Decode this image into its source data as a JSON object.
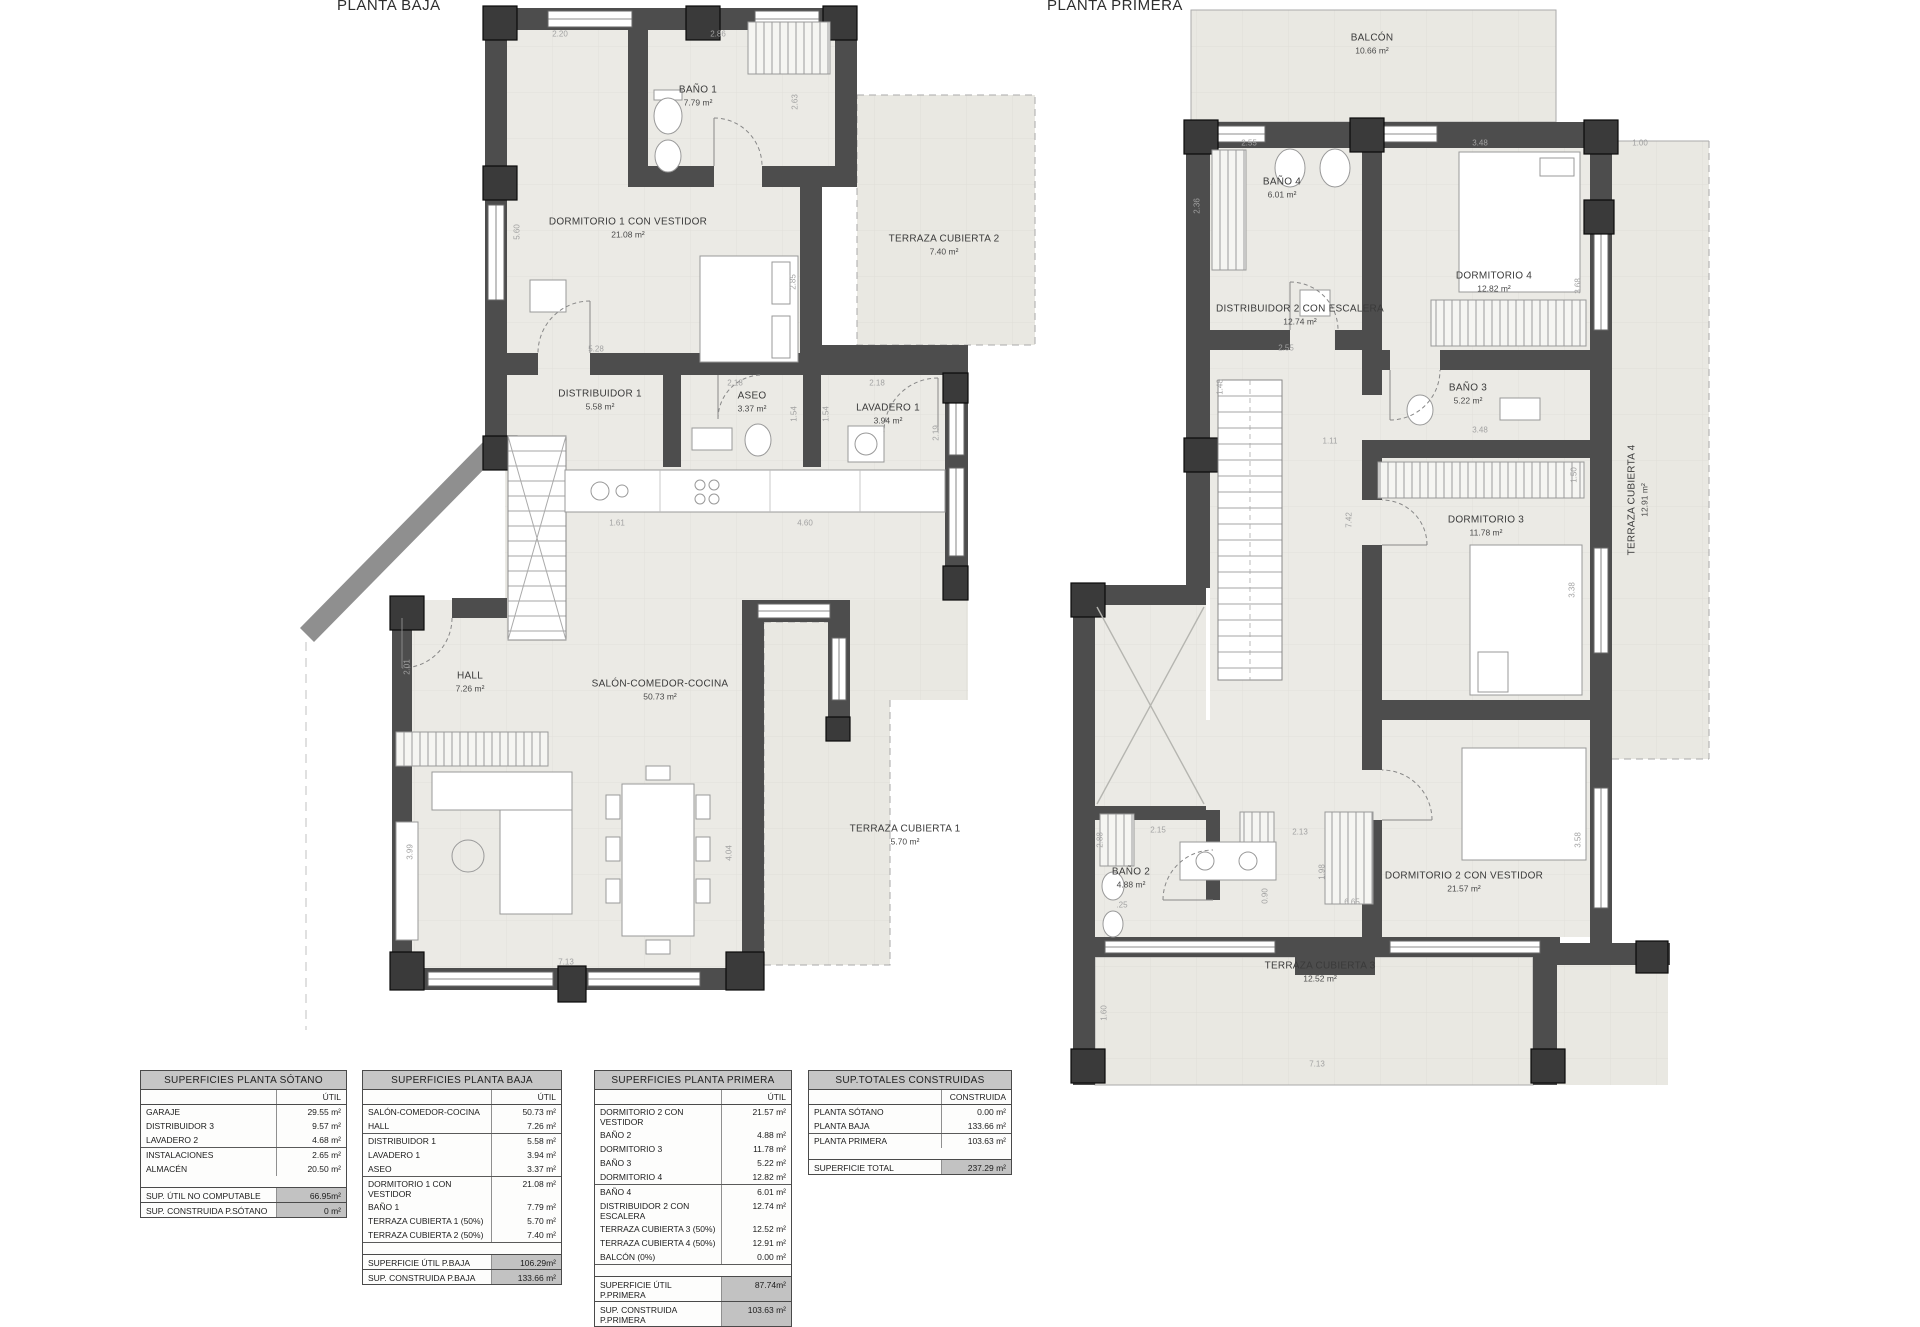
{
  "plans": [
    {
      "id": "baja",
      "title": "PLANTA BAJA",
      "rooms": [
        {
          "name": "BAÑO 1",
          "area": "7.79 m²",
          "x": 698,
          "y": 96
        },
        {
          "name": "DORMITORIO 1 CON VESTIDOR",
          "area": "21.08 m²",
          "x": 628,
          "y": 228
        },
        {
          "name": "TERRAZA CUBIERTA 2",
          "area": "7.40 m²",
          "x": 944,
          "y": 245
        },
        {
          "name": "DISTRIBUIDOR 1",
          "area": "5.58 m²",
          "x": 600,
          "y": 400
        },
        {
          "name": "ASEO",
          "area": "3.37 m²",
          "x": 752,
          "y": 402
        },
        {
          "name": "LAVADERO 1",
          "area": "3.94 m²",
          "x": 888,
          "y": 414
        },
        {
          "name": "HALL",
          "area": "7.26 m²",
          "x": 470,
          "y": 682
        },
        {
          "name": "SALÓN-COMEDOR-COCINA",
          "area": "50.73 m²",
          "x": 660,
          "y": 690
        },
        {
          "name": "TERRAZA CUBIERTA 1",
          "area": "5.70 m²",
          "x": 905,
          "y": 835
        }
      ],
      "dims": [
        {
          "t": "2.20",
          "x": 560,
          "y": 34
        },
        {
          "t": "2.86",
          "x": 718,
          "y": 34
        },
        {
          "t": "5.60",
          "x": 517,
          "y": 232,
          "rot": 1
        },
        {
          "t": "2.63",
          "x": 795,
          "y": 102,
          "rot": 1
        },
        {
          "t": "2.85",
          "x": 793,
          "y": 282,
          "rot": 1
        },
        {
          "t": "5.28",
          "x": 596,
          "y": 349
        },
        {
          "t": "2.18",
          "x": 735,
          "y": 383
        },
        {
          "t": "2.18",
          "x": 877,
          "y": 383
        },
        {
          "t": "1.54",
          "x": 794,
          "y": 414,
          "rot": 1
        },
        {
          "t": "1.54",
          "x": 826,
          "y": 414,
          "rot": 1
        },
        {
          "t": "2.19",
          "x": 936,
          "y": 433,
          "rot": 1
        },
        {
          "t": "1.61",
          "x": 617,
          "y": 523
        },
        {
          "t": "4.60",
          "x": 805,
          "y": 523
        },
        {
          "t": "2.01",
          "x": 407,
          "y": 667,
          "rot": 1
        },
        {
          "t": "3.99",
          "x": 410,
          "y": 852,
          "rot": 1
        },
        {
          "t": "4.04",
          "x": 729,
          "y": 853,
          "rot": 1
        },
        {
          "t": "7.13",
          "x": 566,
          "y": 962
        }
      ]
    },
    {
      "id": "primera",
      "title": "PLANTA PRIMERA",
      "rooms": [
        {
          "name": "BALCÓN",
          "area": "10.66 m²",
          "x": 1372,
          "y": 44
        },
        {
          "name": "BAÑO 4",
          "area": "6.01 m²",
          "x": 1282,
          "y": 188
        },
        {
          "name": "DORMITORIO 4",
          "area": "12.82 m²",
          "x": 1494,
          "y": 282
        },
        {
          "name": "DISTRIBUIDOR 2 CON ESCALERA",
          "area": "12.74 m²",
          "x": 1300,
          "y": 315
        },
        {
          "name": "BAÑO 3",
          "area": "5.22 m²",
          "x": 1468,
          "y": 394
        },
        {
          "name": "DORMITORIO 3",
          "area": "11.78 m²",
          "x": 1486,
          "y": 526
        },
        {
          "name": "TERRAZA CUBIERTA 4",
          "area": "12.91 m²",
          "x": 1638,
          "y": 500,
          "rot": 1
        },
        {
          "name": "BAÑO 2",
          "area": "4.88 m²",
          "x": 1131,
          "y": 878
        },
        {
          "name": "DORMITORIO 2 CON VESTIDOR",
          "area": "21.57 m²",
          "x": 1464,
          "y": 882
        },
        {
          "name": "TERRAZA CUBIERTA 3",
          "area": "12.52 m²",
          "x": 1320,
          "y": 972
        }
      ],
      "dims": [
        {
          "t": "2.55",
          "x": 1249,
          "y": 143
        },
        {
          "t": "3.48",
          "x": 1480,
          "y": 143
        },
        {
          "t": "1.00",
          "x": 1640,
          "y": 143
        },
        {
          "t": "2.36",
          "x": 1197,
          "y": 206,
          "rot": 1
        },
        {
          "t": "3.68",
          "x": 1578,
          "y": 286,
          "rot": 1
        },
        {
          "t": "2.55",
          "x": 1286,
          "y": 348
        },
        {
          "t": "1.48",
          "x": 1220,
          "y": 387,
          "rot": 1
        },
        {
          "t": "1.11",
          "x": 1330,
          "y": 441
        },
        {
          "t": "3.48",
          "x": 1480,
          "y": 430
        },
        {
          "t": "1.50",
          "x": 1574,
          "y": 475,
          "rot": 1
        },
        {
          "t": "7.42",
          "x": 1349,
          "y": 520,
          "rot": 1
        },
        {
          "t": "3.38",
          "x": 1572,
          "y": 590,
          "rot": 1
        },
        {
          "t": "2.15",
          "x": 1158,
          "y": 830
        },
        {
          "t": "2.13",
          "x": 1300,
          "y": 832
        },
        {
          "t": "1.98",
          "x": 1322,
          "y": 872,
          "rot": 1
        },
        {
          "t": "0.90",
          "x": 1265,
          "y": 896,
          "rot": 1
        },
        {
          "t": "2.88",
          "x": 1100,
          "y": 840,
          "rot": 1
        },
        {
          "t": ".25",
          "x": 1122,
          "y": 905
        },
        {
          "t": "6.65",
          "x": 1352,
          "y": 902
        },
        {
          "t": "3.58",
          "x": 1578,
          "y": 840,
          "rot": 1
        },
        {
          "t": "1.60",
          "x": 1104,
          "y": 1013,
          "rot": 1
        },
        {
          "t": "7.13",
          "x": 1317,
          "y": 1064
        }
      ]
    }
  ],
  "tables": [
    {
      "title": "SUPERFICIES PLANTA SÓTANO",
      "col": "ÚTIL",
      "rows": [
        {
          "l": "GARAJE",
          "v": "29.55 m²"
        },
        {
          "l": "DISTRIBUIDOR 3",
          "v": "9.57 m²"
        },
        {
          "l": "LAVADERO 2",
          "v": "4.68 m²",
          "sep": 1
        },
        {
          "l": "INSTALACIONES",
          "v": "2.65 m²"
        },
        {
          "l": "ALMACÉN",
          "v": "20.50 m²"
        }
      ],
      "totals": [
        {
          "l": "SUP. ÚTIL NO COMPUTABLE",
          "v": "66.95m²"
        },
        {
          "l": "SUP. CONSTRUIDA P.SÓTANO",
          "v": "0 m²"
        }
      ]
    },
    {
      "title": "SUPERFICIES PLANTA BAJA",
      "col": "ÚTIL",
      "rows": [
        {
          "l": "SALÓN-COMEDOR-COCINA",
          "v": "50.73 m²"
        },
        {
          "l": "HALL",
          "v": "7.26 m²",
          "sep": 1
        },
        {
          "l": "DISTRIBUIDOR 1",
          "v": "5.58 m²"
        },
        {
          "l": "LAVADERO 1",
          "v": "3.94 m²"
        },
        {
          "l": "ASEO",
          "v": "3.37 m²",
          "sep": 1
        },
        {
          "l": "DORMITORIO 1 CON VESTIDOR",
          "v": "21.08 m²"
        },
        {
          "l": "BAÑO 1",
          "v": "7.79 m²"
        },
        {
          "l": "TERRAZA CUBIERTA 1 (50%)",
          "v": "5.70 m²"
        },
        {
          "l": "TERRAZA CUBIERTA 2 (50%)",
          "v": "7.40 m²",
          "sep": 1
        }
      ],
      "totals": [
        {
          "l": "SUPERFICIE ÚTIL P.BAJA",
          "v": "106.29m²"
        },
        {
          "l": "SUP. CONSTRUIDA P.BAJA",
          "v": "133.66 m²"
        }
      ]
    },
    {
      "title": "SUPERFICIES PLANTA PRIMERA",
      "col": "ÚTIL",
      "rows": [
        {
          "l": "DORMITORIO 2 CON VESTIDOR",
          "v": "21.57 m²"
        },
        {
          "l": "BAÑO 2",
          "v": "4.88 m²"
        },
        {
          "l": "DORMITORIO 3",
          "v": "11.78 m²"
        },
        {
          "l": "BAÑO 3",
          "v": "5.22 m²"
        },
        {
          "l": "DORMITORIO 4",
          "v": "12.82 m²",
          "sep": 1
        },
        {
          "l": "BAÑO 4",
          "v": "6.01 m²"
        },
        {
          "l": "DISTRIBUIDOR 2 CON ESCALERA",
          "v": "12.74 m²"
        },
        {
          "l": "TERRAZA CUBIERTA 3 (50%)",
          "v": "12.52 m²"
        },
        {
          "l": "TERRAZA CUBIERTA 4 (50%)",
          "v": "12.91 m²"
        },
        {
          "l": "BALCÓN (0%)",
          "v": "0.00 m²",
          "sep": 1
        }
      ],
      "totals": [
        {
          "l": "SUPERFICIE ÚTIL P.PRIMERA",
          "v": "87.74m²"
        },
        {
          "l": "SUP. CONSTRUIDA P.PRIMERA",
          "v": "103.63 m²"
        }
      ]
    },
    {
      "title": "SUP.TOTALES CONSTRUIDAS",
      "col": "CONSTRUIDA",
      "rows": [
        {
          "l": "PLANTA SÓTANO",
          "v": "0.00 m²"
        },
        {
          "l": "PLANTA BAJA",
          "v": "133.66 m²",
          "sep": 1
        },
        {
          "l": "PLANTA PRIMERA",
          "v": "103.63 m²"
        }
      ],
      "totals": [
        {
          "l": "SUPERFICIE TOTAL",
          "v": "237.29 m²"
        }
      ]
    }
  ]
}
